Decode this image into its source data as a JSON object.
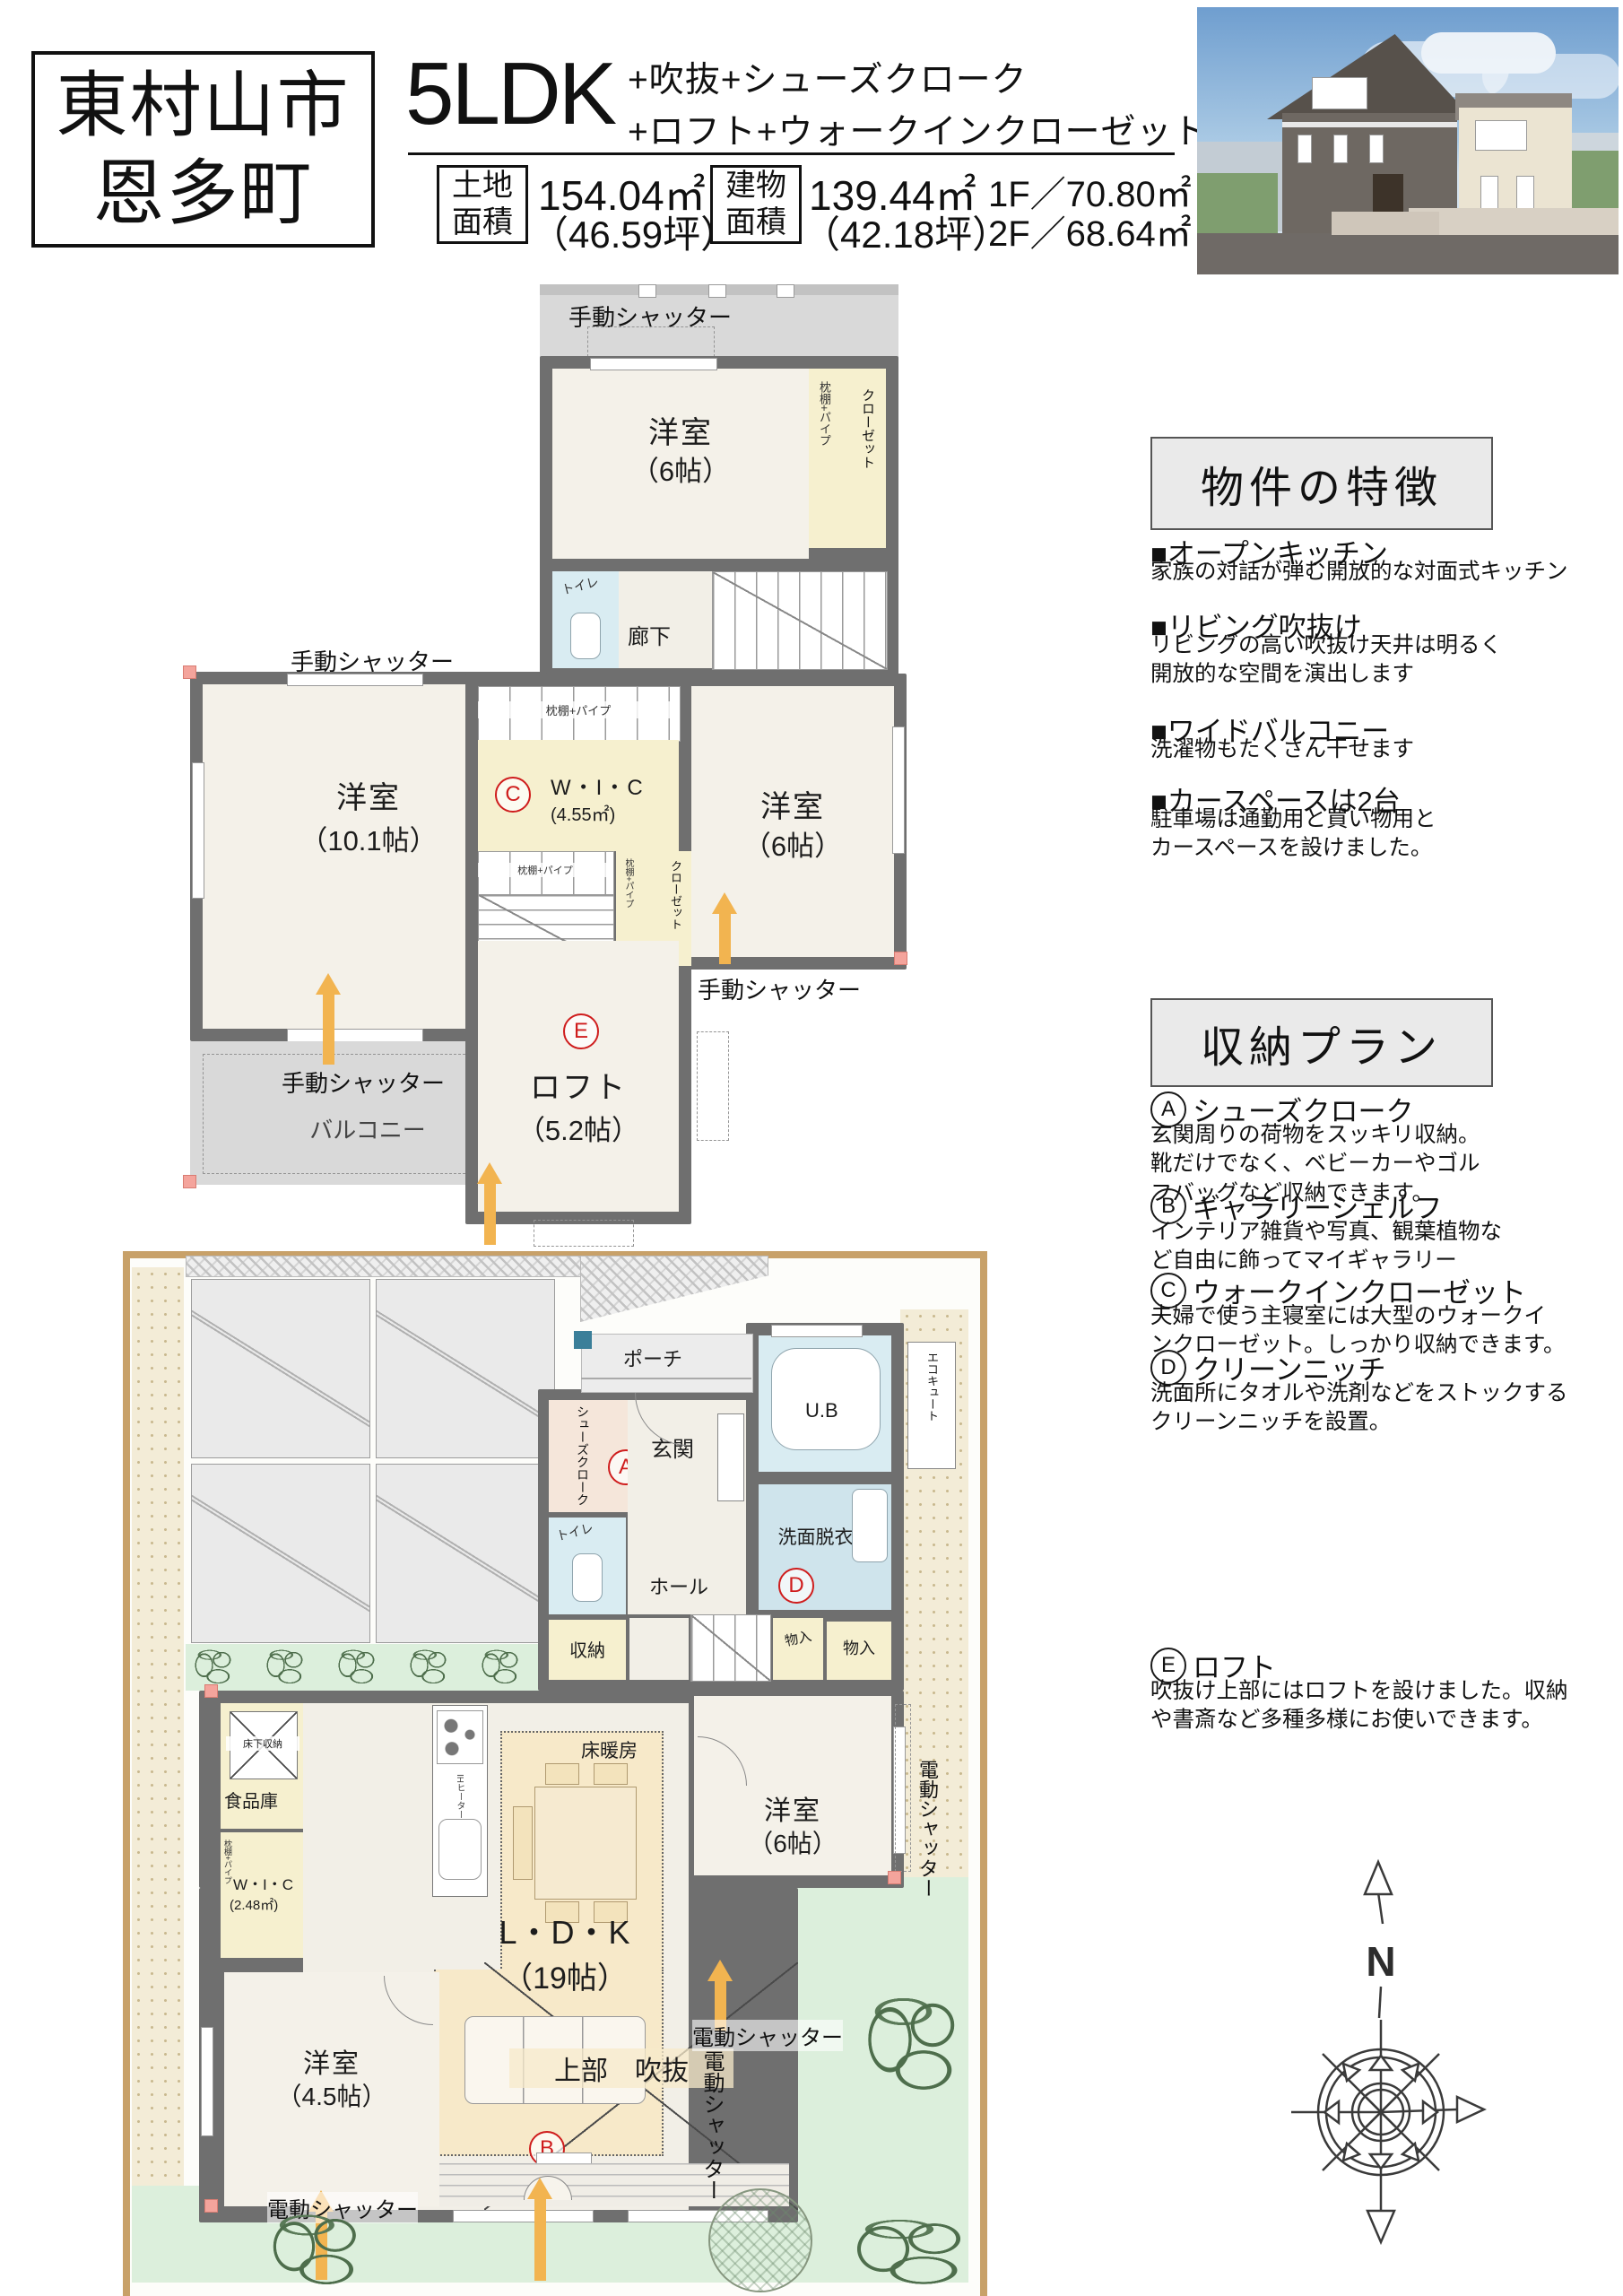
{
  "colors": {
    "wall": "#6f6f6f",
    "mark_red": "#cf1d1d",
    "arrow_orange": "#f2b450",
    "closet_yellow": "#f6f0cf",
    "water_blue": "#d9ecf2",
    "ldk_beige": "#f7e9c9",
    "lawn_green": "#dcefdc",
    "balcony_gray": "#d9d9d9",
    "site_border_tan": "#c8a169"
  },
  "header": {
    "location_line1": "東村山市",
    "location_line2": "恩多町",
    "layout": "5LDK",
    "features_line1": "+吹抜+シューズクローク",
    "features_line2": "+ロフト+ウォークインクローゼット",
    "land": {
      "label_line1": "土地",
      "label_line2": "面積",
      "area": "154.04㎡",
      "tsubo": "（46.59坪）"
    },
    "building": {
      "label_line1": "建物",
      "label_line2": "面積",
      "area": "139.44㎡",
      "tsubo": "（42.18坪）",
      "floor1": "1F／70.80㎡",
      "floor2": "2F／68.64㎡"
    }
  },
  "features_panel": {
    "title": "物件の特徴",
    "items": [
      {
        "heading": "■オープンキッチン",
        "body": "家族の対話が弾む開放的な対面式キッチン"
      },
      {
        "heading": "■リビング吹抜け",
        "body": "リビングの高い吹抜け天井は明るく\n開放的な空間を演出します"
      },
      {
        "heading": "■ワイドバルコニー",
        "body": "洗濯物もたくさん干せます"
      },
      {
        "heading": "■カースペースは2台",
        "body": "駐車場は通勤用と買い物用と\nカースペースを設けました。"
      }
    ]
  },
  "storage_panel": {
    "title": "収納プラン",
    "items": [
      {
        "mark": "A",
        "heading": "シューズクローク",
        "body": "玄関周りの荷物をスッキリ収納。\n靴だけでなく、ベビーカーやゴル\nフバッグなど収納できます。"
      },
      {
        "mark": "B",
        "heading": "ギャラリーシェルフ",
        "body": "インテリア雑貨や写真、観葉植物な\nど自由に飾ってマイギャラリー"
      },
      {
        "mark": "C",
        "heading": "ウォークインクローゼット",
        "body": "夫婦で使う主寝室には大型のウォークイ\nンクローゼット。しっかり収納できます。"
      },
      {
        "mark": "D",
        "heading": "クリーンニッチ",
        "body": "洗面所にタオルや洗剤などをストックする\nクリーンニッチを設置。"
      },
      {
        "mark": "E",
        "heading": "ロフト",
        "body": "吹抜け上部にはロフトを設けました。収納\nや書斎など多種多様にお使いできます。"
      }
    ]
  },
  "plan2f": {
    "manual_shutter": "手動シャッター",
    "balcony": "バルコニー",
    "corridor": "廊下",
    "toilet": "トイレ",
    "closet": "クローゼット",
    "shelf_pipe": "枕棚+パイプ",
    "room_top": {
      "name": "洋室",
      "size": "（6帖）"
    },
    "room_left": {
      "name": "洋室",
      "size": "（10.1帖）"
    },
    "room_right": {
      "name": "洋室",
      "size": "（6帖）"
    },
    "wic": {
      "mark": "C",
      "name": "W・I・C",
      "size": "(4.55㎡)"
    },
    "loft": {
      "mark": "E",
      "name": "ロフト",
      "size": "（5.2帖）"
    }
  },
  "plan1f": {
    "electric_shutter": "電動シャッター",
    "porch": "ポーチ",
    "entrance": "玄関",
    "hall": "ホール",
    "shoes_cloak": {
      "mark": "A",
      "name": "シューズクローク"
    },
    "unit_bath": "U.B",
    "ecocute": "エコキュート",
    "washroom": {
      "mark": "D",
      "name": "洗面脱衣室"
    },
    "toilet": "トイレ",
    "storage": "収納",
    "closet_a": "物入",
    "closet_b": "物入",
    "pantry": "食品庫",
    "underfloor_storage": "床下収納",
    "wic": {
      "name": "W・I・C",
      "size": "(2.48㎡)",
      "shelf": "枕棚+パイプ"
    },
    "ih_heater": "IHヒーター",
    "floor_heating": "床暖房",
    "ldk": {
      "name": "L・D・K",
      "size": "（19帖）"
    },
    "room6": {
      "name": "洋室",
      "size": "（6帖）"
    },
    "room45": {
      "name": "洋室",
      "size": "（4.5帖）"
    },
    "void_above": {
      "mark": "B",
      "label": "上部　吹抜"
    }
  },
  "compass": {
    "north_label": "N"
  }
}
